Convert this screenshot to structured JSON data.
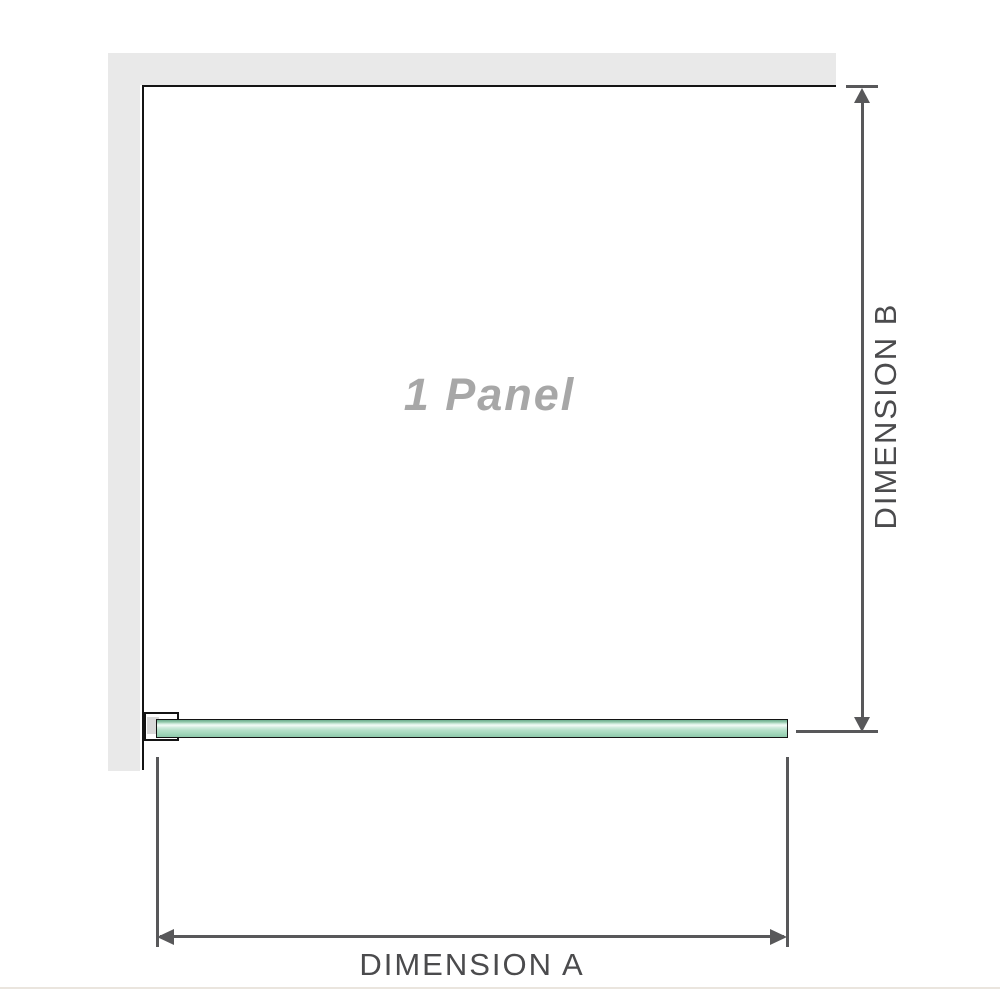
{
  "diagram": {
    "panel_label": "1 Panel",
    "dimension_a_label": "DIMENSION A",
    "dimension_b_label": "DIMENSION B"
  },
  "colors": {
    "wall": "#e9e9e9",
    "edge": "#141414",
    "dimension_line": "#58585a",
    "dimension_text": "#4b4b4d",
    "panel_label_text": "#a7a7a7",
    "glass_green": "#a3d8bc",
    "glass_highlight": "#f2fbf6",
    "glass_dark_green": "#6cab8c",
    "bracket_fill": "#d9d9d9",
    "baseline": "#eae5de"
  }
}
